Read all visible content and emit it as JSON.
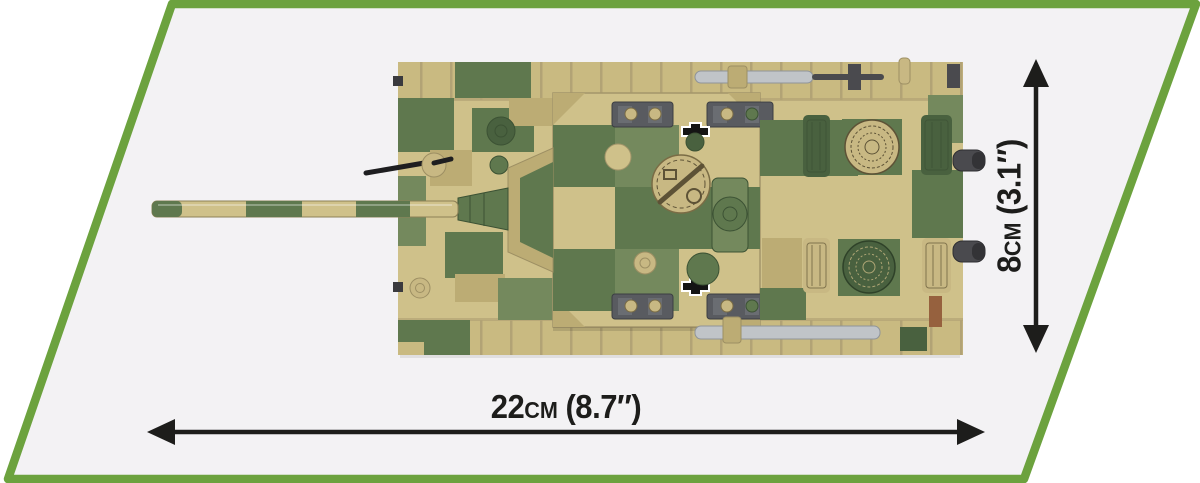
{
  "palette": {
    "page_bg": "#ffffff",
    "panel_bg": "#f3f2f4",
    "frame_green": "#6ca23e",
    "ink": "#1d1d1b",
    "sand": "#cfc18a",
    "sand_dark": "#bcac74",
    "track_sand": "#c9ba81",
    "olive": "#5f784e",
    "olive_light": "#74895d",
    "olive_dark": "#49613f",
    "tan": "#c8b883",
    "link_gray": "#595b60",
    "cable_silver": "#c0c4c8",
    "metal_dark": "#46464a",
    "rust_brown": "#96613e"
  },
  "dimensions": {
    "horizontal": {
      "value": "22",
      "unit": "cm",
      "imperial": "(8.7″)"
    },
    "vertical": {
      "value": "8",
      "unit": "cm",
      "imperial": "(3.1″)"
    }
  }
}
